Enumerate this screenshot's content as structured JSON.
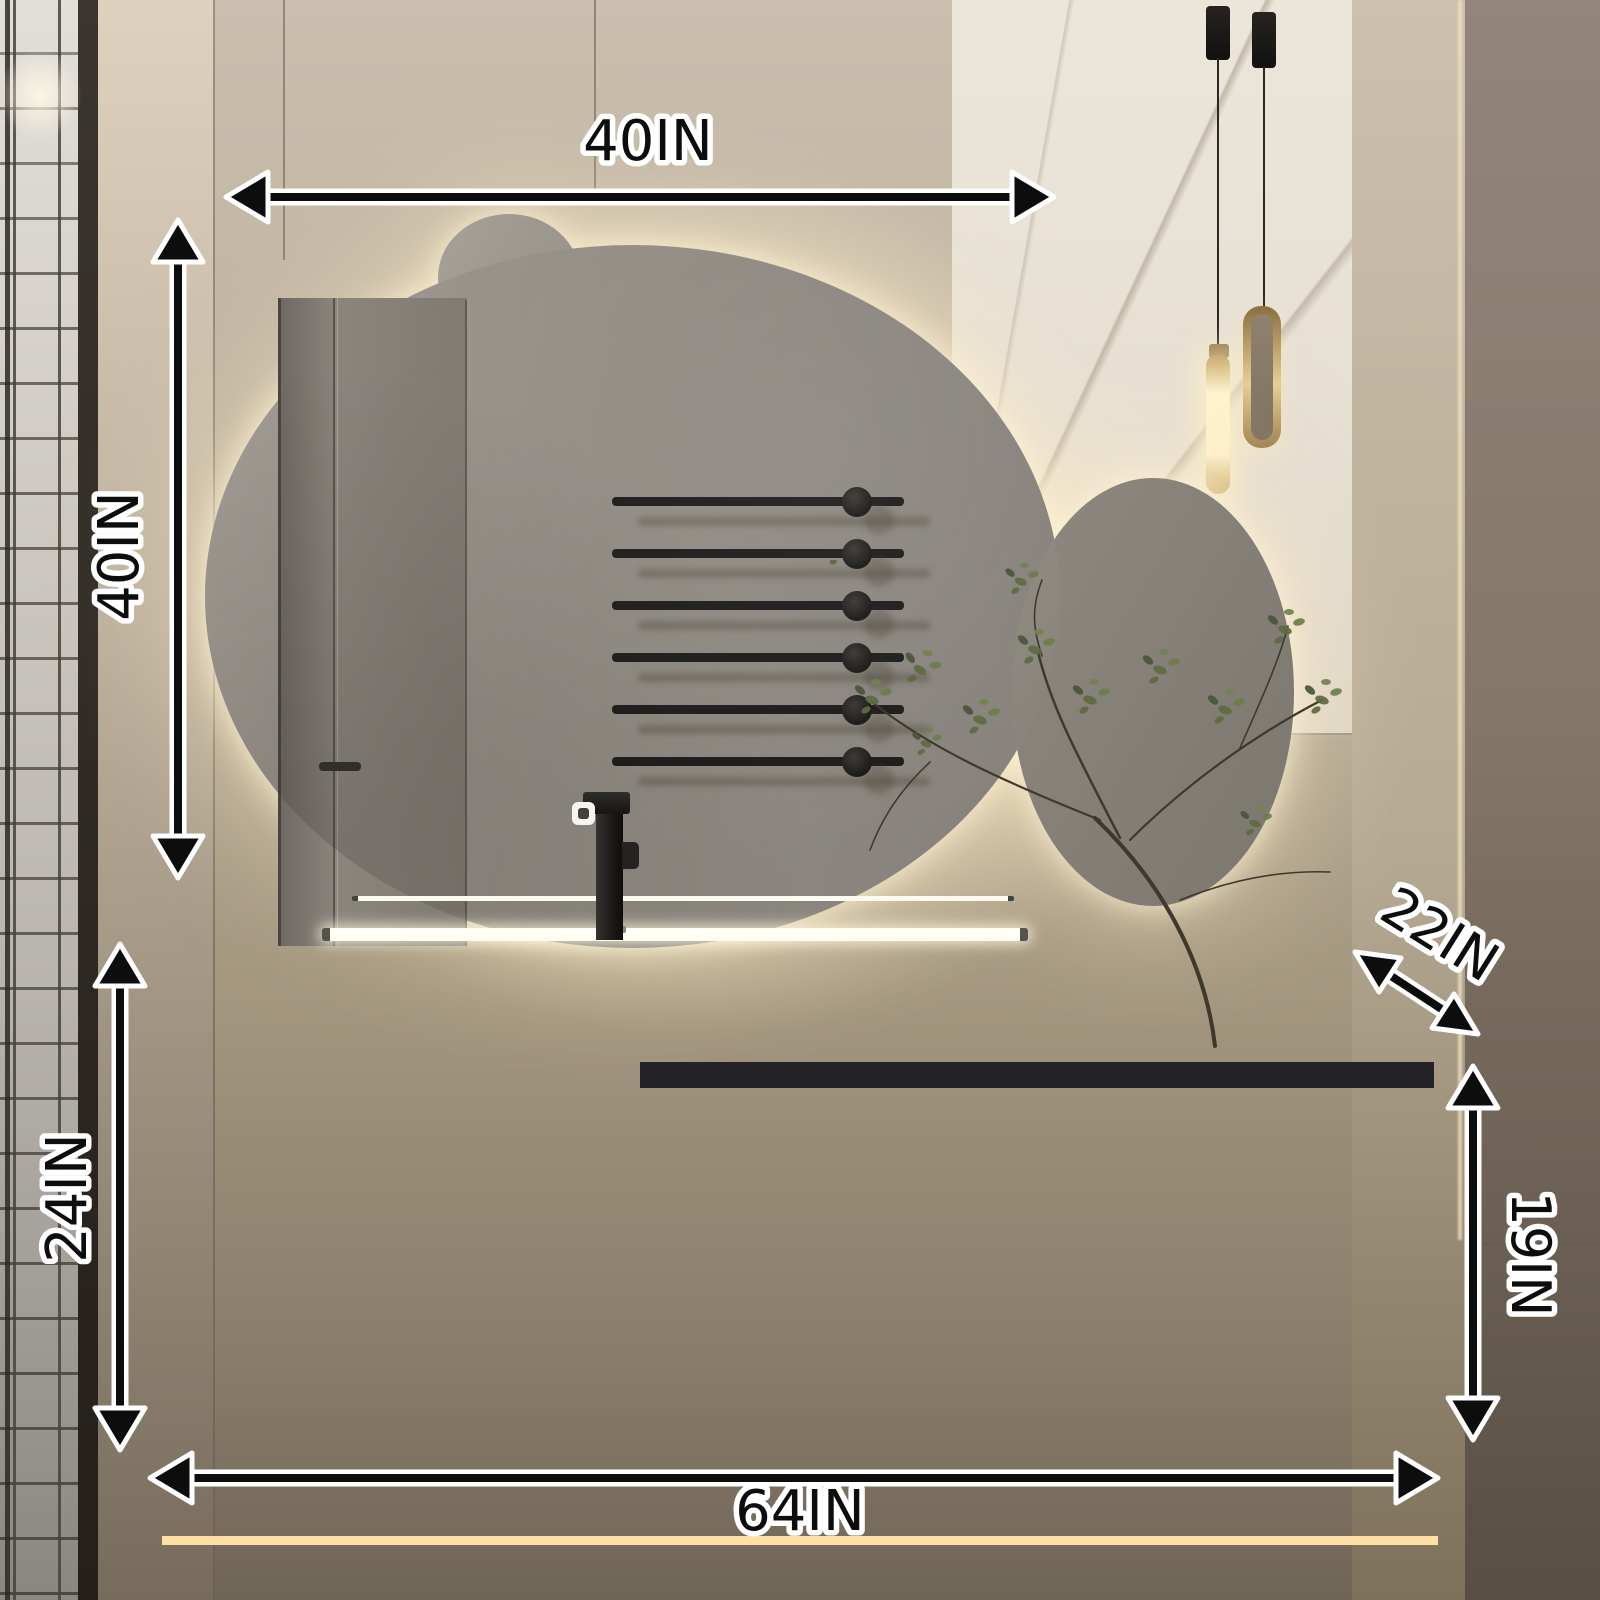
{
  "annotations": {
    "items": [
      {
        "id": "mirror-width",
        "label": "40IN",
        "orientation": "horizontal"
      },
      {
        "id": "mirror-height",
        "label": "40IN",
        "orientation": "vertical"
      },
      {
        "id": "counter-depth",
        "label": "22IN",
        "orientation": "diagonal"
      },
      {
        "id": "left-cabinet-height",
        "label": "24IN",
        "orientation": "vertical"
      },
      {
        "id": "right-cabinet-height",
        "label": "19IN",
        "orientation": "vertical"
      },
      {
        "id": "cabinet-width",
        "label": "64IN",
        "orientation": "horizontal"
      }
    ],
    "colors": {
      "text": "#0d0d0d",
      "outline": "#ffffff",
      "led_glow": "#ffeec9"
    }
  }
}
